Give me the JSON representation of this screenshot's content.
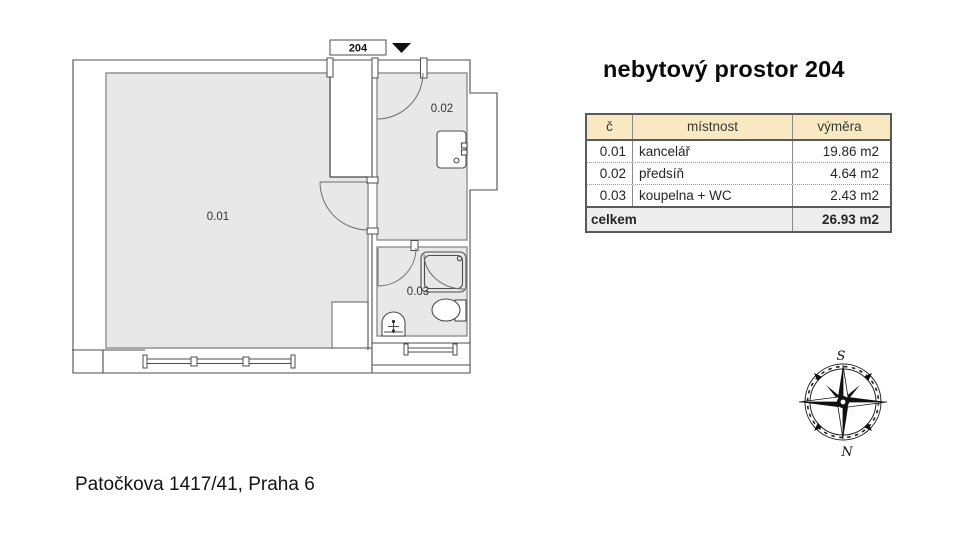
{
  "title": "nebytový prostor 204",
  "address": "Patočkova 1417/41, Praha 6",
  "floor_plan": {
    "unit_label": "204",
    "rooms": [
      {
        "id": "0.01",
        "name": "kancelář"
      },
      {
        "id": "0.02",
        "name": "předsíň"
      },
      {
        "id": "0.03",
        "name": "koupelna + WC"
      }
    ]
  },
  "table": {
    "headers": {
      "num": "č",
      "room": "místnost",
      "area": "výměra"
    },
    "rows": [
      {
        "num": "0.01",
        "room": "kancelář",
        "area": "19.86 m2"
      },
      {
        "num": "0.02",
        "room": "předsíň",
        "area": "4.64 m2"
      },
      {
        "num": "0.03",
        "room": "koupelna + WC",
        "area": "2.43 m2"
      }
    ],
    "footer": {
      "label": "celkem",
      "area": "26.93 m2"
    }
  },
  "compass": {
    "south_label": "S",
    "north_label": "N"
  },
  "colors": {
    "room_fill": "#e8e8e8",
    "header_bg": "#f8e9c2",
    "footer_bg": "#ededed",
    "table_border": "#5a5a5a",
    "wall_line": "#4d4d4d"
  }
}
